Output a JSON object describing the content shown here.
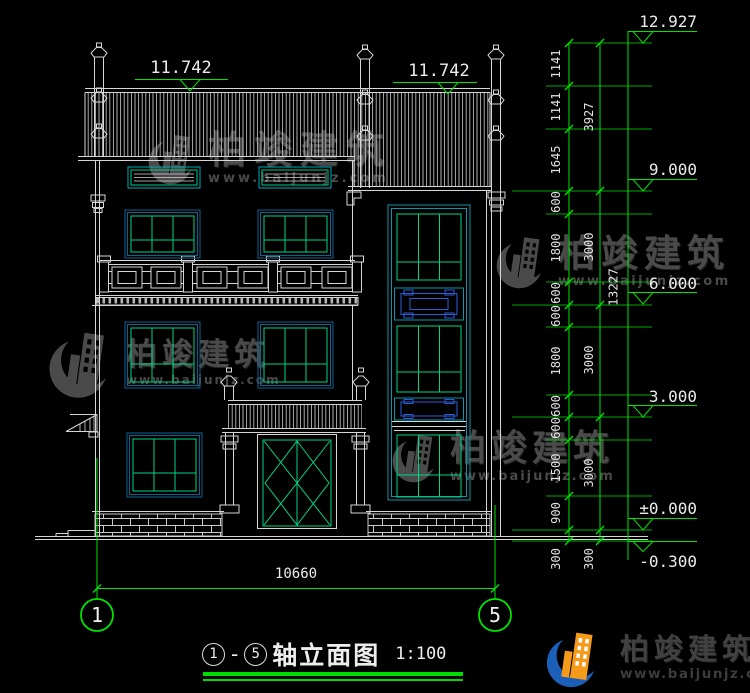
{
  "drawing": {
    "roof_elevation_left": "11.742",
    "roof_elevation_right": "11.742",
    "levels": [
      "12.927",
      "9.000",
      "6.000",
      "3.000",
      "±0.000",
      "-0.300"
    ]
  },
  "dimensions": {
    "inner_chain": [
      "1141",
      "1141",
      "1645",
      "600",
      "1800",
      "600",
      "600",
      "1800",
      "600",
      "600",
      "1500",
      "900",
      "300"
    ],
    "outer_chain": [
      "3927",
      "3000",
      "3000",
      "3000",
      "300"
    ],
    "total_height": "13227",
    "overall_width": "10660"
  },
  "axis_bubbles": {
    "start": "1",
    "end": "5"
  },
  "title": {
    "axis_start": "1",
    "dash": "-",
    "axis_end": "5",
    "name": "轴立面图",
    "scale": "1:100"
  },
  "watermark": {
    "brand": "柏竣建筑",
    "url": "www.baijunjz.com"
  },
  "footer": {
    "brand": "柏竣建筑",
    "url": "www.baijunjz.com"
  }
}
